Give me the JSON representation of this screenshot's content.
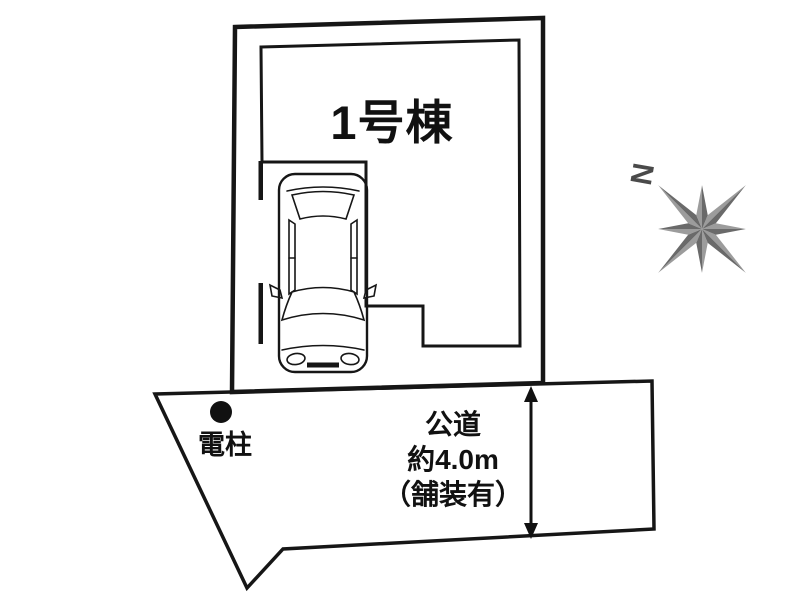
{
  "plot": {
    "building_label": "1号棟"
  },
  "road": {
    "name": "公道",
    "width": "約4.0m",
    "surface": "（舗装有）",
    "pole_label": "電柱"
  },
  "compass": {
    "north_label": "N"
  },
  "colors": {
    "plot_green": "#9fc9ae",
    "building_beige": "#e9e0c7",
    "road_gray": "#c8c8c8",
    "line_black": "#161616",
    "compass_light": "#9c9c9c",
    "compass_dark": "#6a6a6a",
    "car_body": "#ffffff"
  }
}
